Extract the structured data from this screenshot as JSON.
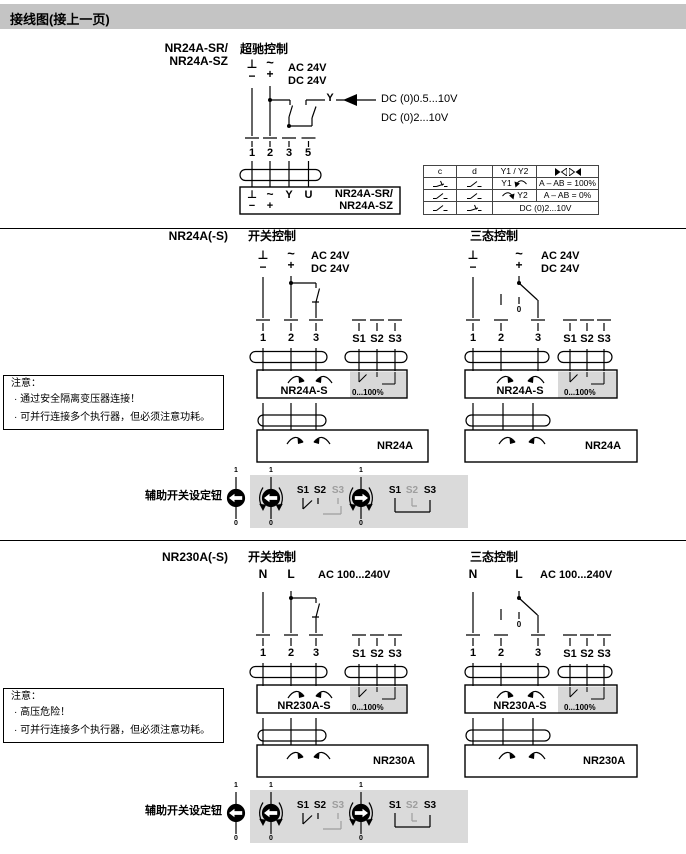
{
  "header": {
    "title": "接线图(接上一页)"
  },
  "colors": {
    "header_bg": "#c4c4c4",
    "panel_gray": "#dadada",
    "subpanel_gray": "#d8d8d8",
    "muted": "#9e9e9e"
  },
  "symbols": {
    "ground": "⊥",
    "minus": "−",
    "tilde": "~",
    "plus": "+",
    "neutral": "N",
    "line": "L"
  },
  "shared": {
    "s1": "S1",
    "s2": "S2",
    "s3": "S3",
    "one": "1",
    "zero": "0",
    "aux_label": "辅助开关设定钮"
  },
  "override": {
    "model_line1": "NR24A-SR/",
    "model_line2": "NR24A-SZ",
    "title": "超驰控制",
    "ac": "AC 24V",
    "dc": "DC 24V",
    "y": "Y",
    "range1": "DC (0)0.5...10V",
    "range2": "DC (0)2...10V",
    "terminals": [
      "1",
      "2",
      "3",
      "5"
    ],
    "plug_top": [
      "⊥",
      "~",
      "Y",
      "U"
    ],
    "plug_bottom": [
      "−",
      "+"
    ],
    "plug_model1": "NR24A-SR/",
    "plug_model2": "NR24A-SZ",
    "table": {
      "c": "c",
      "d": "d",
      "y": "Y1 / Y2",
      "r1y": "Y1",
      "r1v": "A – AB = 100%",
      "r2y": "Y2",
      "r2v": "A – AB = 0%",
      "r3v": "DC (0)2...10V"
    }
  },
  "nr24": {
    "model": "NR24A(-S)",
    "left_title": "开关控制",
    "right_title": "三态控制",
    "ac": "AC 24V",
    "dc": "DC 24V",
    "terminals": [
      "1",
      "2",
      "3"
    ],
    "actuator_s": "NR24A-S",
    "range": "0...100%",
    "actuator": "NR24A",
    "note_title": "注意：",
    "note1": "· 通过安全隔离变压器连接！",
    "note2": "· 可并行连接多个执行器，但必须注意功耗。"
  },
  "nr230": {
    "model": "NR230A(-S)",
    "left_title": "开关控制",
    "right_title": "三态控制",
    "ac": "AC 100...240V",
    "terminals": [
      "1",
      "2",
      "3"
    ],
    "actuator_s": "NR230A-S",
    "range": "0...100%",
    "actuator": "NR230A",
    "note_title": "注意：",
    "note1": "· 高压危险！",
    "note2": "· 可并行连接多个执行器，但必须注意功耗。"
  }
}
